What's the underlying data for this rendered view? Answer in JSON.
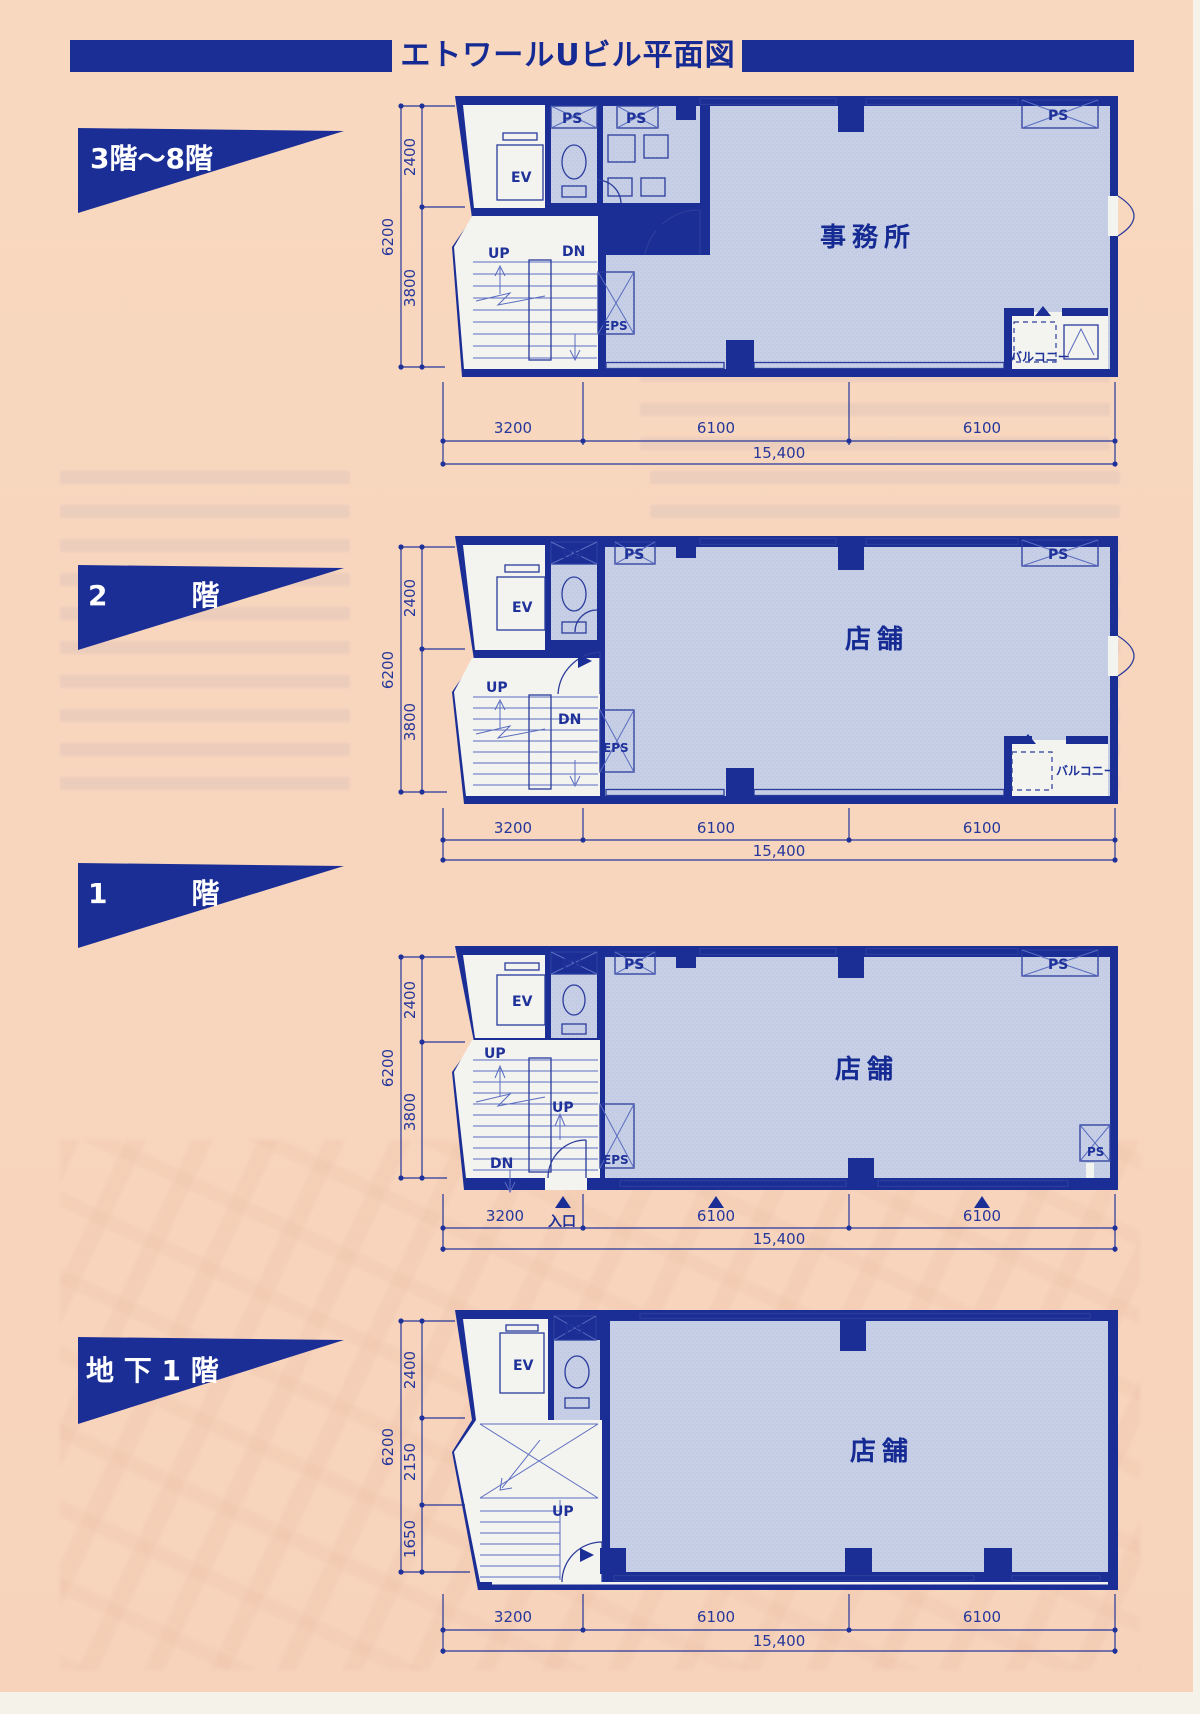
{
  "page": {
    "title": "エトワールUビル平面図"
  },
  "plans": [
    {
      "floor_label": "3階〜8階",
      "room_label": "事務所",
      "balcony_label": "バルコニー",
      "labels": {
        "ps": "PS",
        "ev": "EV",
        "eps": "EPS",
        "up": "UP",
        "dn": "DN"
      },
      "dims": {
        "v_total": "6200",
        "v_seg1": "2400",
        "v_seg2": "3800",
        "h_seg1": "3200",
        "h_seg2": "6100",
        "h_seg3": "6100",
        "h_total": "15,400"
      }
    },
    {
      "floor_label": "2　　　階",
      "room_label": "店舗",
      "balcony_label": "バルコニー",
      "labels": {
        "ps": "PS",
        "ev": "EV",
        "eps": "EPS",
        "up": "UP",
        "dn": "DN"
      },
      "dims": {
        "v_total": "6200",
        "v_seg1": "2400",
        "v_seg2": "3800",
        "h_seg1": "3200",
        "h_seg2": "6100",
        "h_seg3": "6100",
        "h_total": "15,400"
      }
    },
    {
      "floor_label": "1　　　階",
      "room_label": "店舗",
      "entrance_label": "入口",
      "labels": {
        "ps": "PS",
        "ev": "EV",
        "eps": "EPS",
        "up": "UP",
        "up2": "UP",
        "dn": "DN"
      },
      "dims": {
        "v_total": "6200",
        "v_seg1": "2400",
        "v_seg2": "3800",
        "h_seg1": "3200",
        "h_seg2": "6100",
        "h_seg3": "6100",
        "h_total": "15,400"
      }
    },
    {
      "floor_label": "地 下 1 階",
      "room_label": "店舗",
      "labels": {
        "ps": "PS",
        "ev": "EV",
        "up": "UP"
      },
      "dims": {
        "v_total": "6200",
        "v_seg1": "2400",
        "v_seg2": "2150",
        "v_seg3": "1650",
        "h_seg1": "3200",
        "h_seg2": "6100",
        "h_seg3": "6100",
        "h_total": "15,400"
      }
    }
  ]
}
